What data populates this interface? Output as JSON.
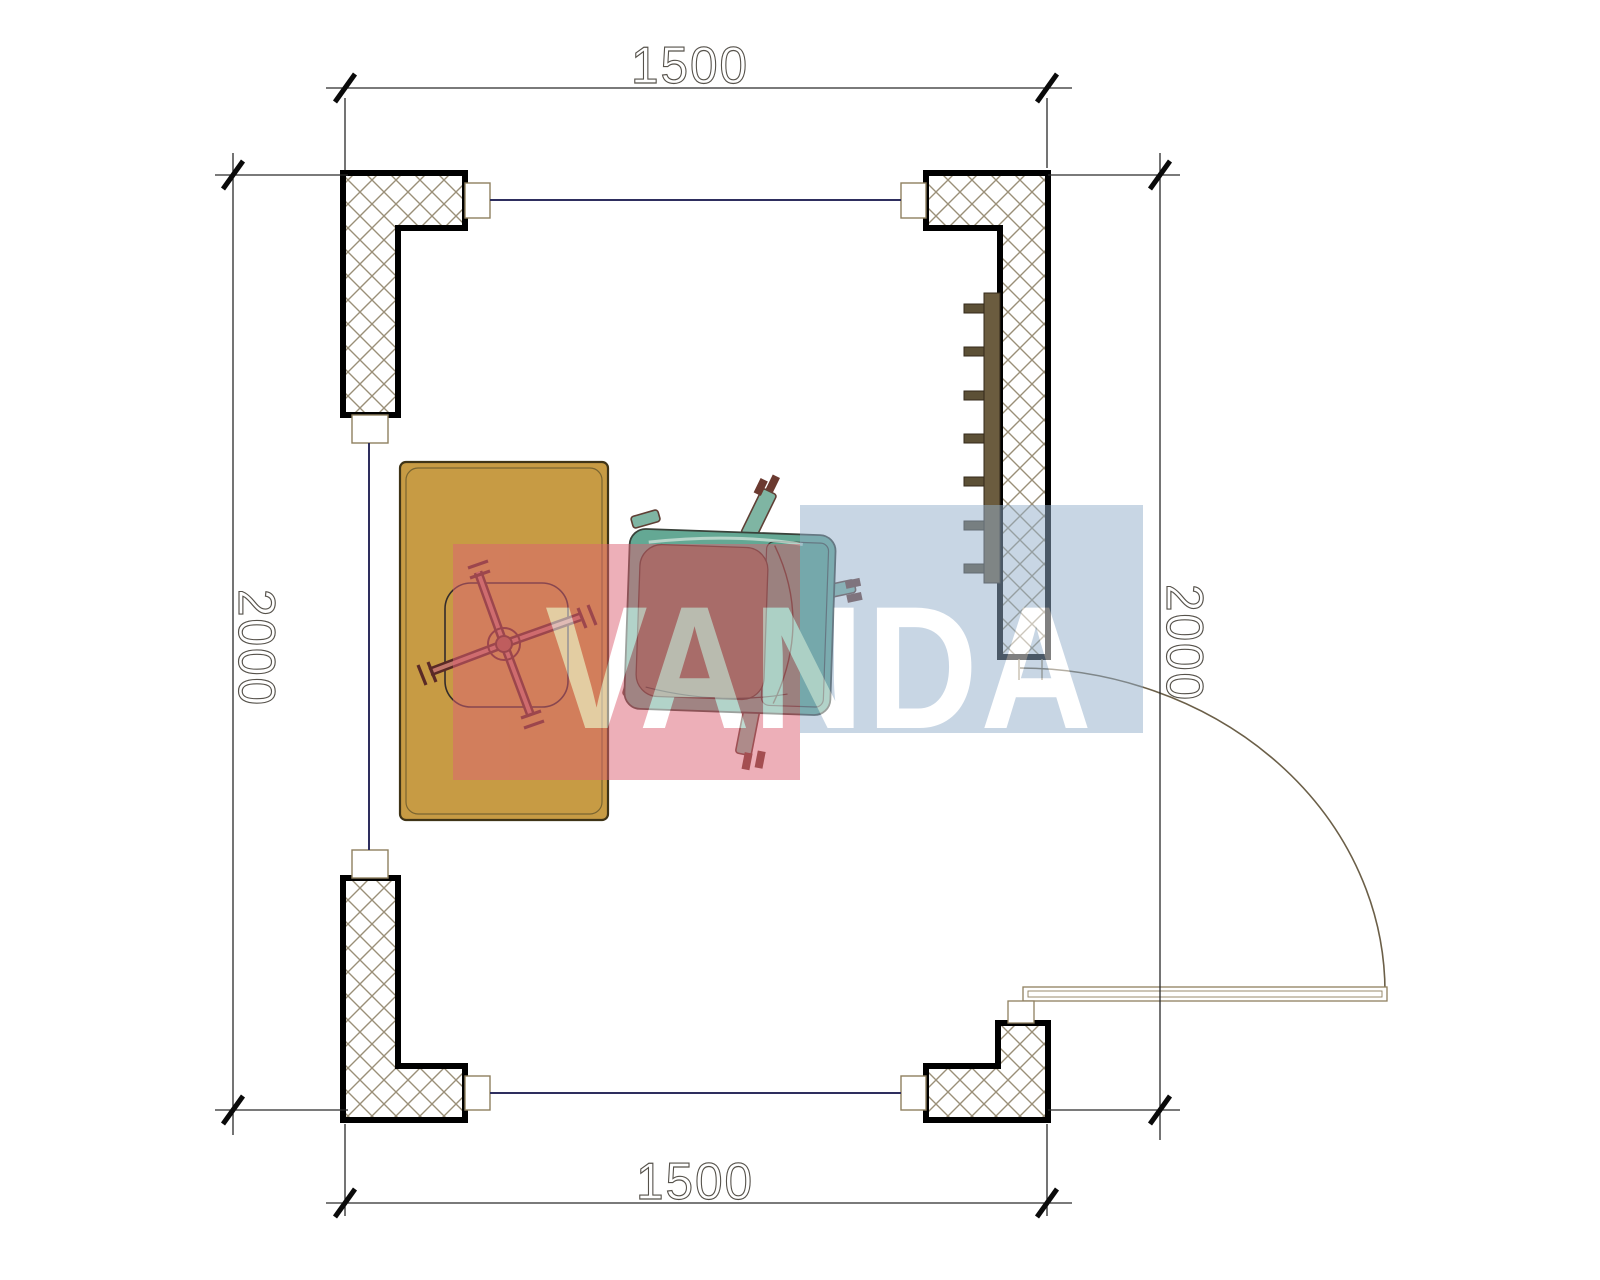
{
  "drawing": {
    "type": "floor-plan",
    "room_clear_width_mm": 1500,
    "room_clear_height_mm": 2000,
    "wall_corner_count": 4,
    "wall_fill": "crosshatch",
    "wall_border_color": "#000000",
    "hatch_line_color": "#9a8f78",
    "window_line_color": "#2e2e5e",
    "window_frame_color": "#8f7f5f"
  },
  "dimensions": {
    "top": "1500",
    "bottom": "1500",
    "left": "2000",
    "right": "2000",
    "line_color": "#2a2a2a",
    "tick_color": "#0a0a0a",
    "text_style": "hollow-outline"
  },
  "furniture": {
    "desk": {
      "name": "desk",
      "fill": "#c79b44",
      "border": "#3f3417"
    },
    "office_chair": {
      "name": "office-chair",
      "base_color": "#a05848",
      "arm_count": 4
    },
    "armchair": {
      "name": "armchair",
      "shell": "#64a894",
      "cushion": "#73775f",
      "leg_outline": "#5f3f35"
    },
    "radiator": {
      "name": "wall-shelf-radiator",
      "bar_color": "#6b5c3f",
      "tab_color": "#5c5036",
      "tab_count": 7
    },
    "door": {
      "name": "door",
      "leaf_outline": "#8f7f5f",
      "swing_arc_color": "#6b5f48"
    }
  },
  "watermark": {
    "text": "VANDA",
    "text_color": "#ffffff",
    "red_block_color": "#dd6273",
    "blue_block_color": "#93afcb",
    "opacity": 0.5
  }
}
